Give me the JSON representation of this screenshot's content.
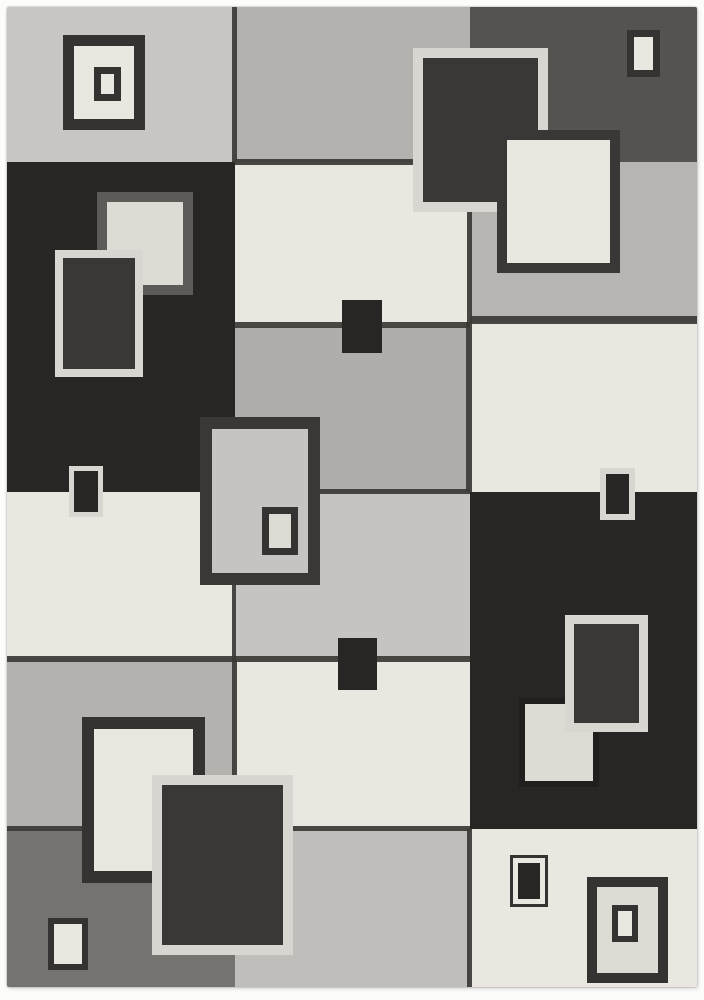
{
  "image": {
    "type": "product-photo",
    "subject": "modern geometric area rug with overlapping squares pattern in gray, charcoal and cream",
    "background_color": "#fcfcfb"
  },
  "palette": {
    "light_gray": "#c8c6c2",
    "medium_gray": "#b4b2ae",
    "gray_b3": "#b0aeaa",
    "gray_b4": "#c6c4c0",
    "gray_b6": "#c0beba",
    "gray_c2": "#b7b5b1",
    "cream": "#e9e7e0",
    "cream_soft": "#dedbd4",
    "charcoal": "#272624",
    "charcoal_soft": "#393836",
    "graphite": "#55524f",
    "slate": "#75736f",
    "border_dark": "#343331",
    "border_gray": "#5d5b58",
    "border_light": "#d8d6d1",
    "border_blend": "#201f1e",
    "seam": "#3b3936"
  },
  "rug": {
    "x": 7,
    "y": 7,
    "width": 690,
    "height": 980,
    "blocks": [
      {
        "name": "block-top-left-lightgray",
        "x": 7,
        "y": 7,
        "w": 228,
        "h": 155,
        "fill": "light_gray",
        "tex": "light"
      },
      {
        "name": "block-top-center-gray",
        "x": 235,
        "y": 7,
        "w": 235,
        "h": 155,
        "fill": "medium_gray",
        "tex": "light"
      },
      {
        "name": "block-top-right-graphite",
        "x": 470,
        "y": 7,
        "w": 227,
        "h": 155,
        "fill": "graphite",
        "tex": "heavy"
      },
      {
        "name": "block-left-charcoal",
        "x": 7,
        "y": 162,
        "w": 228,
        "h": 330,
        "fill": "charcoal",
        "tex": "dark"
      },
      {
        "name": "block-center-cream-row2",
        "x": 235,
        "y": 162,
        "w": 235,
        "h": 165,
        "fill": "cream",
        "tex": "light"
      },
      {
        "name": "block-right-gray-row2",
        "x": 470,
        "y": 162,
        "w": 227,
        "h": 160,
        "fill": "gray_c2",
        "tex": "light"
      },
      {
        "name": "block-center-gray-row3",
        "x": 235,
        "y": 327,
        "w": 235,
        "h": 165,
        "fill": "gray_b3",
        "tex": "light"
      },
      {
        "name": "block-right-cream-row3",
        "x": 470,
        "y": 322,
        "w": 227,
        "h": 170,
        "fill": "cream",
        "tex": "light"
      },
      {
        "name": "block-left-cream-row4",
        "x": 7,
        "y": 492,
        "w": 228,
        "h": 167,
        "fill": "cream",
        "tex": "light"
      },
      {
        "name": "block-center-gray-row4",
        "x": 235,
        "y": 492,
        "w": 235,
        "h": 167,
        "fill": "gray_b4",
        "tex": "light"
      },
      {
        "name": "block-right-charcoal-tall",
        "x": 470,
        "y": 492,
        "w": 227,
        "h": 337,
        "fill": "charcoal",
        "tex": "dark"
      },
      {
        "name": "block-left-gray-row5",
        "x": 7,
        "y": 659,
        "w": 228,
        "h": 170,
        "fill": "medium_gray",
        "tex": "light"
      },
      {
        "name": "block-center-cream-row5",
        "x": 235,
        "y": 659,
        "w": 235,
        "h": 170,
        "fill": "cream",
        "tex": "light"
      },
      {
        "name": "block-left-slate-row6",
        "x": 7,
        "y": 829,
        "w": 228,
        "h": 158,
        "fill": "slate",
        "tex": "slate"
      },
      {
        "name": "block-center-gray-row6",
        "x": 235,
        "y": 829,
        "w": 235,
        "h": 158,
        "fill": "gray_b6",
        "tex": "light"
      },
      {
        "name": "block-right-cream-row6",
        "x": 470,
        "y": 829,
        "w": 227,
        "h": 158,
        "fill": "cream",
        "tex": "light"
      }
    ],
    "seams": [
      {
        "name": "seam-v-top-left",
        "x": 232,
        "y": 7,
        "w": 5,
        "h": 155
      },
      {
        "name": "seam-h-center-row1",
        "x": 235,
        "y": 159,
        "w": 235,
        "h": 6
      },
      {
        "name": "seam-v-right-row2",
        "x": 467,
        "y": 162,
        "w": 5,
        "h": 160
      },
      {
        "name": "seam-h-center-row2",
        "x": 235,
        "y": 322,
        "w": 235,
        "h": 6
      },
      {
        "name": "seam-h-right-row2",
        "x": 470,
        "y": 316,
        "w": 227,
        "h": 8
      },
      {
        "name": "seam-v-right-row3",
        "x": 466,
        "y": 322,
        "w": 6,
        "h": 170
      },
      {
        "name": "seam-h-center-row3",
        "x": 235,
        "y": 489,
        "w": 235,
        "h": 5
      },
      {
        "name": "seam-v-left-row4",
        "x": 232,
        "y": 492,
        "w": 4,
        "h": 167
      },
      {
        "name": "seam-h-left-row4",
        "x": 7,
        "y": 656,
        "w": 228,
        "h": 6
      },
      {
        "name": "seam-h-center-row4",
        "x": 235,
        "y": 656,
        "w": 235,
        "h": 6
      },
      {
        "name": "seam-v-left-row5",
        "x": 232,
        "y": 659,
        "w": 5,
        "h": 170
      },
      {
        "name": "seam-h-left-row5",
        "x": 7,
        "y": 826,
        "w": 228,
        "h": 5
      },
      {
        "name": "seam-h-center-row5",
        "x": 235,
        "y": 826,
        "w": 235,
        "h": 5
      },
      {
        "name": "seam-v-right-row6",
        "x": 467,
        "y": 829,
        "w": 5,
        "h": 158
      }
    ],
    "ornaments": [
      {
        "name": "ornament-topleft-frame",
        "x": 63,
        "y": 35,
        "w": 82,
        "h": 95,
        "bw": 11,
        "bc": "border_dark",
        "fill": "cream"
      },
      {
        "name": "ornament-topleft-inner",
        "x": 94,
        "y": 67,
        "w": 27,
        "h": 34,
        "bw": 7,
        "bc": "border_dark",
        "fill": "cream"
      },
      {
        "name": "ornament-left-cream-square",
        "x": 97,
        "y": 192,
        "w": 96,
        "h": 103,
        "bw": 10,
        "bc": "border_gray",
        "fill": "cream_soft"
      },
      {
        "name": "ornament-left-light-frame",
        "x": 55,
        "y": 250,
        "w": 88,
        "h": 127,
        "bw": 8,
        "bc": "border_light",
        "fill": "charcoal_soft"
      },
      {
        "name": "ornament-left-edge-small",
        "x": 69,
        "y": 466,
        "w": 34,
        "h": 51,
        "bw": 5,
        "bc": "border_light",
        "fill": "charcoal"
      },
      {
        "name": "ornament-center-frame",
        "x": 200,
        "y": 417,
        "w": 120,
        "h": 168,
        "bw": 12,
        "bc": "charcoal_soft",
        "fill": "gray_b4"
      },
      {
        "name": "ornament-center-frame-inner",
        "x": 262,
        "y": 507,
        "w": 36,
        "h": 48,
        "bw": 7,
        "bc": "border_dark",
        "fill": "cream_soft"
      },
      {
        "name": "ornament-center-dark-square-top",
        "x": 342,
        "y": 300,
        "w": 40,
        "h": 53,
        "bw": 0,
        "bc": "charcoal",
        "fill": "charcoal"
      },
      {
        "name": "ornament-center-dark-square-bottom",
        "x": 338,
        "y": 638,
        "w": 39,
        "h": 52,
        "bw": 0,
        "bc": "charcoal",
        "fill": "charcoal"
      },
      {
        "name": "ornament-topright-light-frame",
        "x": 413,
        "y": 48,
        "w": 135,
        "h": 164,
        "bw": 10,
        "bc": "border_light",
        "fill": "charcoal_soft"
      },
      {
        "name": "ornament-topright-cream-square",
        "x": 497,
        "y": 130,
        "w": 123,
        "h": 143,
        "bw": 10,
        "bc": "charcoal_soft",
        "fill": "cream"
      },
      {
        "name": "ornament-topright-small-rect",
        "x": 627,
        "y": 30,
        "w": 33,
        "h": 47,
        "bw": 7,
        "bc": "border_dark",
        "fill": "cream"
      },
      {
        "name": "ornament-right-edge-small",
        "x": 600,
        "y": 468,
        "w": 35,
        "h": 52,
        "bw": 6,
        "bc": "border_light",
        "fill": "charcoal"
      },
      {
        "name": "ornament-right-cream-square",
        "x": 519,
        "y": 698,
        "w": 80,
        "h": 89,
        "bw": 6,
        "bc": "border_blend",
        "fill": "cream_soft"
      },
      {
        "name": "ornament-right-light-frame",
        "x": 565,
        "y": 615,
        "w": 83,
        "h": 117,
        "bw": 9,
        "bc": "border_light",
        "fill": "charcoal_soft"
      },
      {
        "name": "ornament-bottomleft-cream-square",
        "x": 82,
        "y": 717,
        "w": 123,
        "h": 166,
        "bw": 12,
        "bc": "border_dark",
        "fill": "cream"
      },
      {
        "name": "ornament-bottomleft-light-frame",
        "x": 152,
        "y": 775,
        "w": 141,
        "h": 180,
        "bw": 10,
        "bc": "border_light",
        "fill": "charcoal_soft"
      },
      {
        "name": "ornament-bottomleft-small-rect",
        "x": 48,
        "y": 918,
        "w": 40,
        "h": 52,
        "bw": 6,
        "bc": "border_dark",
        "fill": "cream"
      },
      {
        "name": "ornament-bottomright-outline-square",
        "x": 510,
        "y": 855,
        "w": 38,
        "h": 52,
        "bw": 3,
        "bc": "border_dark",
        "fill": "cream"
      },
      {
        "name": "ornament-bottomright-outline-core",
        "x": 518,
        "y": 863,
        "w": 22,
        "h": 36,
        "bw": 0,
        "bc": "charcoal",
        "fill": "charcoal"
      },
      {
        "name": "ornament-bottomright-frame",
        "x": 587,
        "y": 877,
        "w": 81,
        "h": 106,
        "bw": 10,
        "bc": "border_dark",
        "fill": "cream_soft"
      },
      {
        "name": "ornament-bottomright-frame-inner",
        "x": 612,
        "y": 905,
        "w": 26,
        "h": 37,
        "bw": 6,
        "bc": "border_dark",
        "fill": "cream"
      }
    ]
  }
}
